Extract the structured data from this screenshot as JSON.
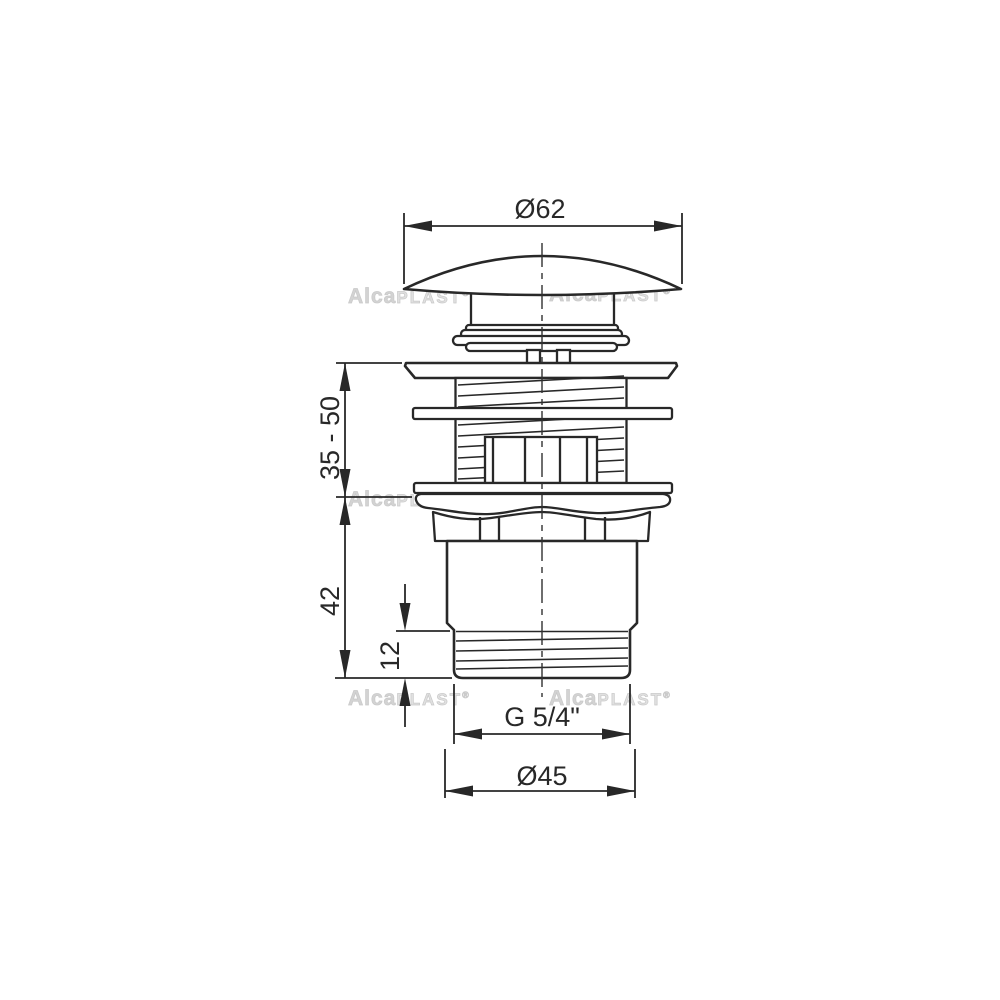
{
  "diagram": {
    "title": "basin click-clack waste valve dimensional drawing",
    "dimensions": {
      "cap_diameter": "Ø62",
      "installation_height_range": "35 - 50",
      "lower_body_height": "42",
      "thread_length": "12",
      "thread_size": "G 5/4\"",
      "body_diameter": "Ø45"
    },
    "watermark": {
      "brand_prefix": "Alca",
      "brand_suffix": "PLAST",
      "registered": "®"
    },
    "colors": {
      "line": "#282828",
      "background": "#ffffff",
      "watermark_light": "#e0e0e0",
      "watermark_dark": "#d3d3d3"
    }
  }
}
